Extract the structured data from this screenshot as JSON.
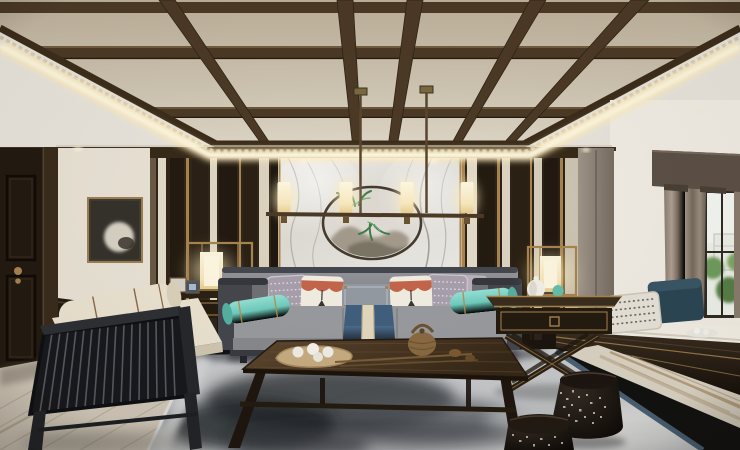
{
  "scene": {
    "description": "3D interior rendering of a new-Chinese-style living room",
    "objects": [
      "coffered dark-wood beam ceiling with warm LED cove lighting and recessed downlights",
      "linear chandelier with two drop rods and four glowing cylinder shades",
      "marble feature wall with circular ring artwork, ink mountains and green plants",
      "dark wood slat walls with cream and brass vertical stripes",
      "dark entry door with brass knobs and framed moon artwork beside it",
      "grey sofa with charcoal frame, teal bolsters, patterned and tasselled pillows, blue runner",
      "two brass-framed lantern table lamps on X-leg side tables",
      "dark walnut coffee table with tea tray, woven teapot and lotus stems",
      "slatted armchair with cream cushions",
      "bay window seat with navy and patterned pillows, taupe curtains, greenery outside",
      "two perforated black drum stools",
      "ink-wash grey area rug with blue border over travertine and plank flooring"
    ]
  },
  "palette": {
    "ceiling_beige": "#cdc2ae",
    "ceiling_outer": "#e9e5dd",
    "beam": "#4c3a26",
    "beam_dark": "#2f2314",
    "glow_warm": "#ffedbe",
    "glow_core": "#fffbe9",
    "wall_cream": "#eae3d6",
    "wood_dark": "#2b2014",
    "wood_mid": "#42331f",
    "brass": "#a88550",
    "marble_light": "#eceae5",
    "marble_vein": "#a29d95",
    "ring_dark": "#443a2e",
    "plant_green": "#3f7c49",
    "door_dark": "#231a11",
    "curtain": "#978a7c",
    "valance": "#5d5146",
    "window_glass": "#eef2ea",
    "tree_green": "#6f9c5d",
    "sofa_frame": "#45474e",
    "sofa_fabric": "#8f9094",
    "seat_fabric": "#9a9b9f",
    "teal": "#6fccbd",
    "orange": "#c5664a",
    "pillow_white": "#f3eee2",
    "pillow_grey": "#a8a0ac",
    "lumbar_grey": "#949aa2",
    "runner_blue": "#41607f",
    "runner_stripe": "#e4d8bd",
    "table_wood": "#4c3a26",
    "table_wood_dark": "#241a10",
    "rug_base": "#c7c9cb",
    "rug_ink": "#2d3136",
    "rug_border_blue": "#4a6073",
    "floor_left": "#d0c7b8",
    "plank": "#b3a896",
    "travertine": "#dcd4c4",
    "trav_streak": "#ad9470",
    "cushion_cream": "#ece4d1",
    "chair_frame": "#26282c",
    "stool_dark": "#1d1510",
    "lamp_glow": "#f8e7b4",
    "white_jar": "#f4f1ea",
    "teal_ornament": "#63c1ad",
    "bench_wood": "#2a2016",
    "cabinet": "#8f857a",
    "navy_pillow": "#2c4654",
    "seat_white": "#f4f0e6"
  }
}
